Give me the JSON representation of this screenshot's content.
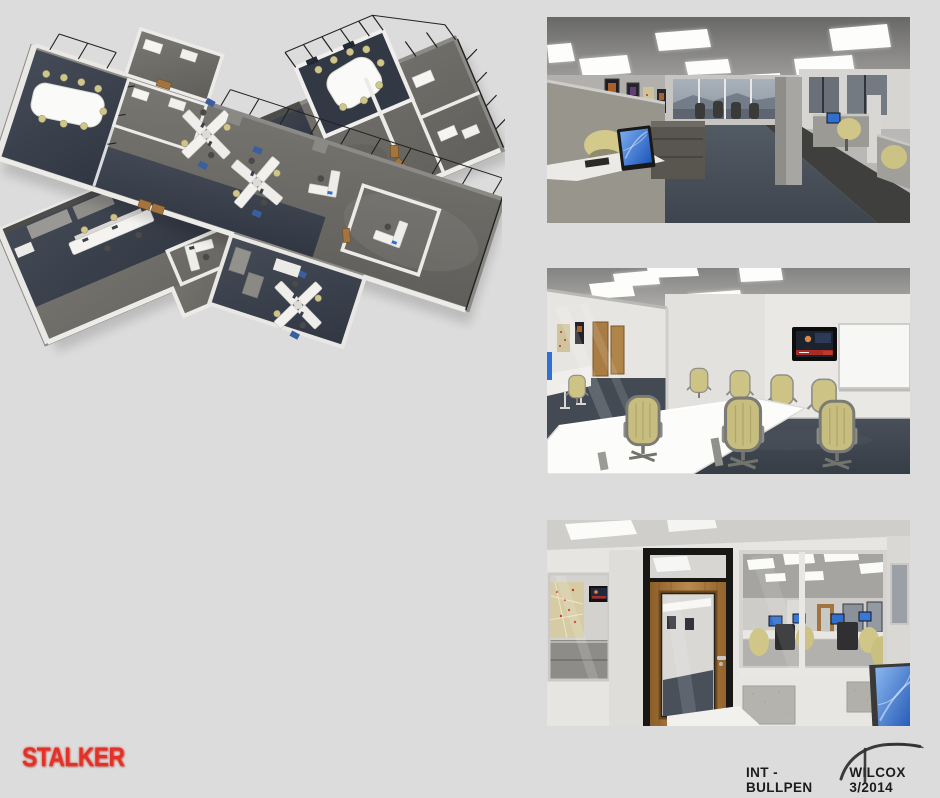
{
  "footer": {
    "show_title": "STALKER",
    "scene_label": "INT - BULLPEN",
    "credit": "WILCOX 3/2014"
  },
  "panels": {
    "aerial_top": {
      "label": "aerial cutaway rendering of bullpen floor plan, view from northeast"
    },
    "aerial_bottom": {
      "label": "aerial cutaway rendering of bullpen floor plan, view from southwest"
    },
    "perspective_top": {
      "label": "interior rendering of bullpen corridor with cubicles and window view"
    },
    "perspective_middle": {
      "label": "interior rendering of conference room with table, chairs and wall TV"
    },
    "perspective_bottom": {
      "label": "interior rendering of wood office door and glass wall looking into bullpen"
    }
  },
  "palette": {
    "board_background": "#dcdcdc",
    "title_red": "#e23127",
    "caption_ink": "#1c1c1c",
    "floor_navy": "#3a414b",
    "carpet_gray": "#6e6c68",
    "screen_blue": "#2f6fd0",
    "chair_tan": "#cfc687",
    "door_wood": "#a3743d",
    "wall_white": "#f0efed"
  }
}
